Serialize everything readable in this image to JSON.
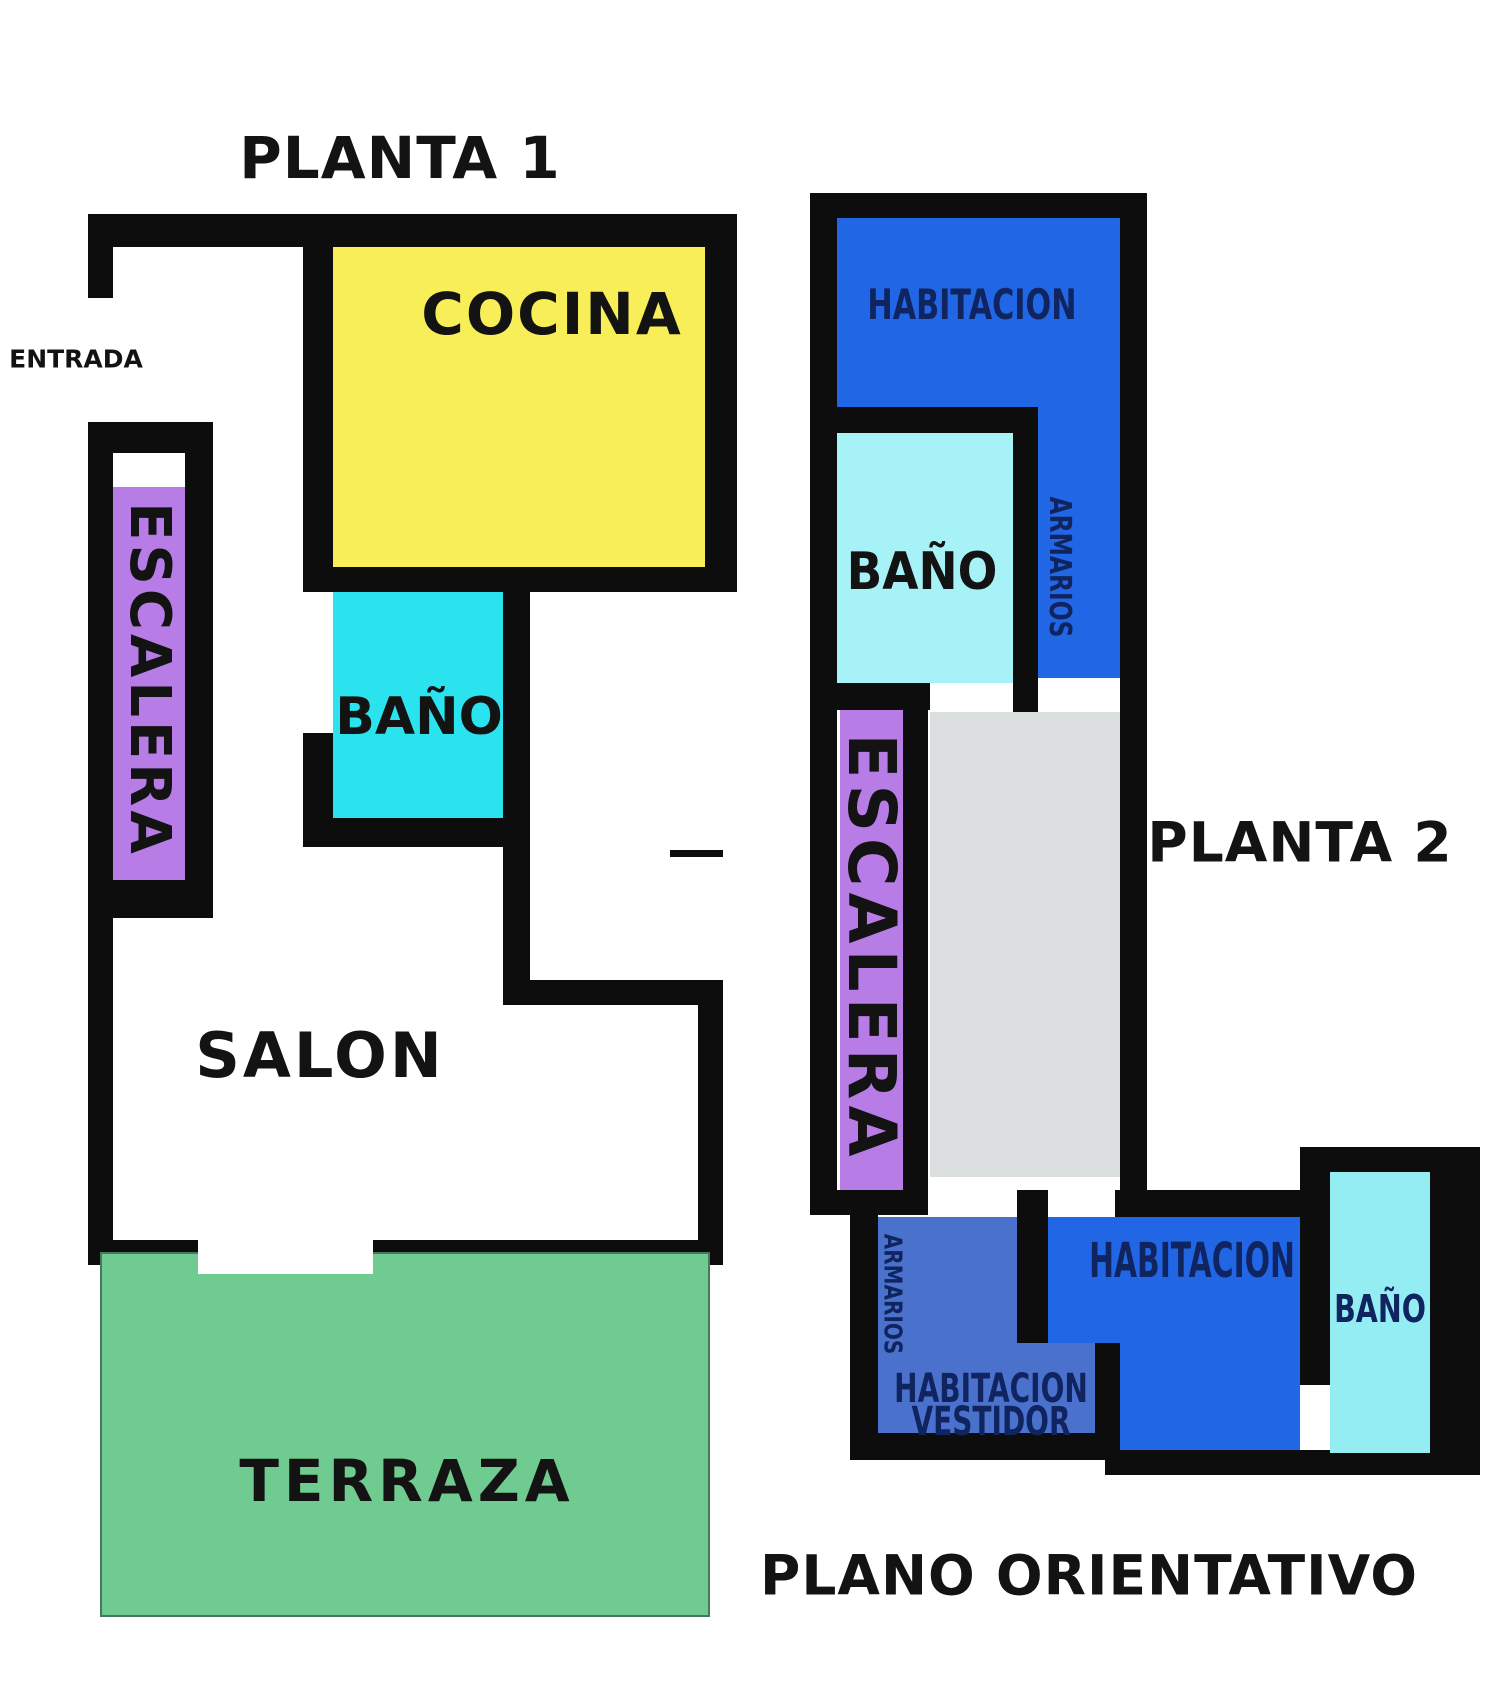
{
  "footer": "PLANO ORIENTATIVO",
  "floor1": {
    "title": "PLANTA 1",
    "entrada": "ENTRADA",
    "cocina": "COCINA",
    "bano": "BAÑO",
    "escalera": "ESCALERA",
    "salon": "SALON",
    "terraza": "TERRAZA"
  },
  "floor2": {
    "title": "PLANTA 2",
    "habitacion_top": "HABITACION",
    "bano_top": "BAÑO",
    "armarios_top": "ARMARIOS",
    "escalera": "ESCALERA",
    "habitacion_bottom": "HABITACION",
    "bano_bottom": "BAÑO",
    "armarios_bottom": "ARMARIOS",
    "vestidor_line1": "HABITACION",
    "vestidor_line2": "VESTIDOR"
  },
  "colors": {
    "wall": "#0d0d0d",
    "cocina_yellow": "#f7ee58",
    "bano_cyan": "#2ae3ee",
    "escalera_purple": "#b77ce5",
    "terraza_green": "#70cb90",
    "habitacion_blue": "#2166e4",
    "bano_pale_cyan": "#a6f2f7",
    "hall_gray": "#dbdedf",
    "vestidor_blue": "#4a72cc",
    "bano_cyan_small": "#93edf3",
    "label_navy": "#102460",
    "label_black": "#131313",
    "white": "#ffffff"
  }
}
